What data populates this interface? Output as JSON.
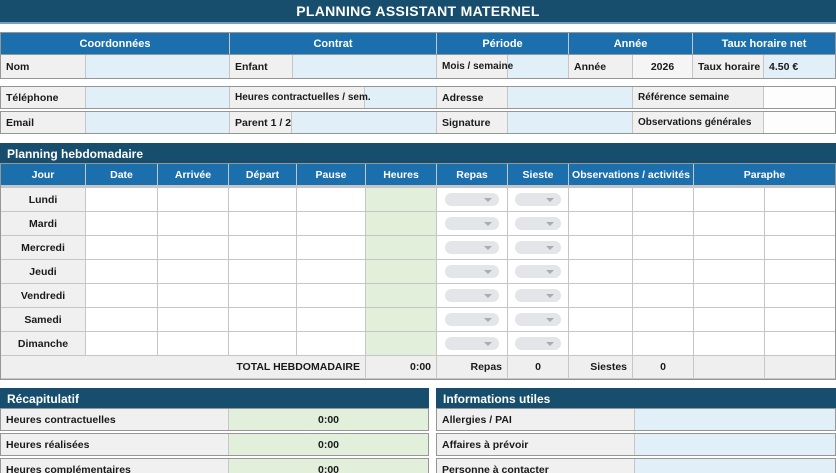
{
  "title": "PLANNING ASSISTANT MATERNEL",
  "colors": {
    "navy": "#174E6D",
    "header_blue": "#1B6FAD",
    "input_blue": "#E1EFF9",
    "hours_green": "#E2EFDA",
    "total_cream": "#FDF2CD",
    "value_blue": "#2222DD",
    "label_grey": "#F0F0F0"
  },
  "top": {
    "sections": [
      "Coordonnées",
      "Contrat",
      "Période",
      "Année",
      "Taux horaire net"
    ],
    "row1": {
      "nom_label": "Nom",
      "enfant_label": "Enfant",
      "mois_label": "Mois / semaine",
      "annee_label": "Année",
      "annee_value": "2026",
      "taux_label": "Taux horaire",
      "taux_value": "4.50 €"
    },
    "row2": {
      "telephone_label": "Téléphone",
      "heures_label": "Heures contractuelles / sem.",
      "adresse_label": "Adresse",
      "reference_label": "Référence semaine"
    },
    "row3": {
      "email_label": "Email",
      "parent_label": "Parent 1 / 2",
      "signature_label": "Signature",
      "observations_label": "Observations générales"
    }
  },
  "planning": {
    "section_title": "Planning hebdomadaire",
    "headers": [
      "Jour",
      "Date",
      "Arrivée",
      "Départ",
      "Pause",
      "Heures",
      "Repas",
      "Sieste",
      "Observations / activités",
      "Paraphe"
    ],
    "days": [
      "Lundi",
      "Mardi",
      "Mercredi",
      "Jeudi",
      "Vendredi",
      "Samedi",
      "Dimanche"
    ],
    "total": {
      "label": "TOTAL HEBDOMADAIRE",
      "heures": "0:00",
      "repas_label": "Repas",
      "repas_value": "0",
      "siestes_label": "Siestes",
      "siestes_value": "0"
    }
  },
  "recap": {
    "section_title": "Récapitulatif",
    "rows": [
      {
        "label": "Heures contractuelles",
        "value": "0:00"
      },
      {
        "label": "Heures réalisées",
        "value": "0:00"
      },
      {
        "label": "Heures complémentaires",
        "value": "0:00"
      }
    ]
  },
  "infos": {
    "section_title": "Informations utiles",
    "rows": [
      {
        "label": "Allergies / PAI"
      },
      {
        "label": "Affaires à prévoir"
      },
      {
        "label": "Personne à contacter"
      }
    ]
  }
}
